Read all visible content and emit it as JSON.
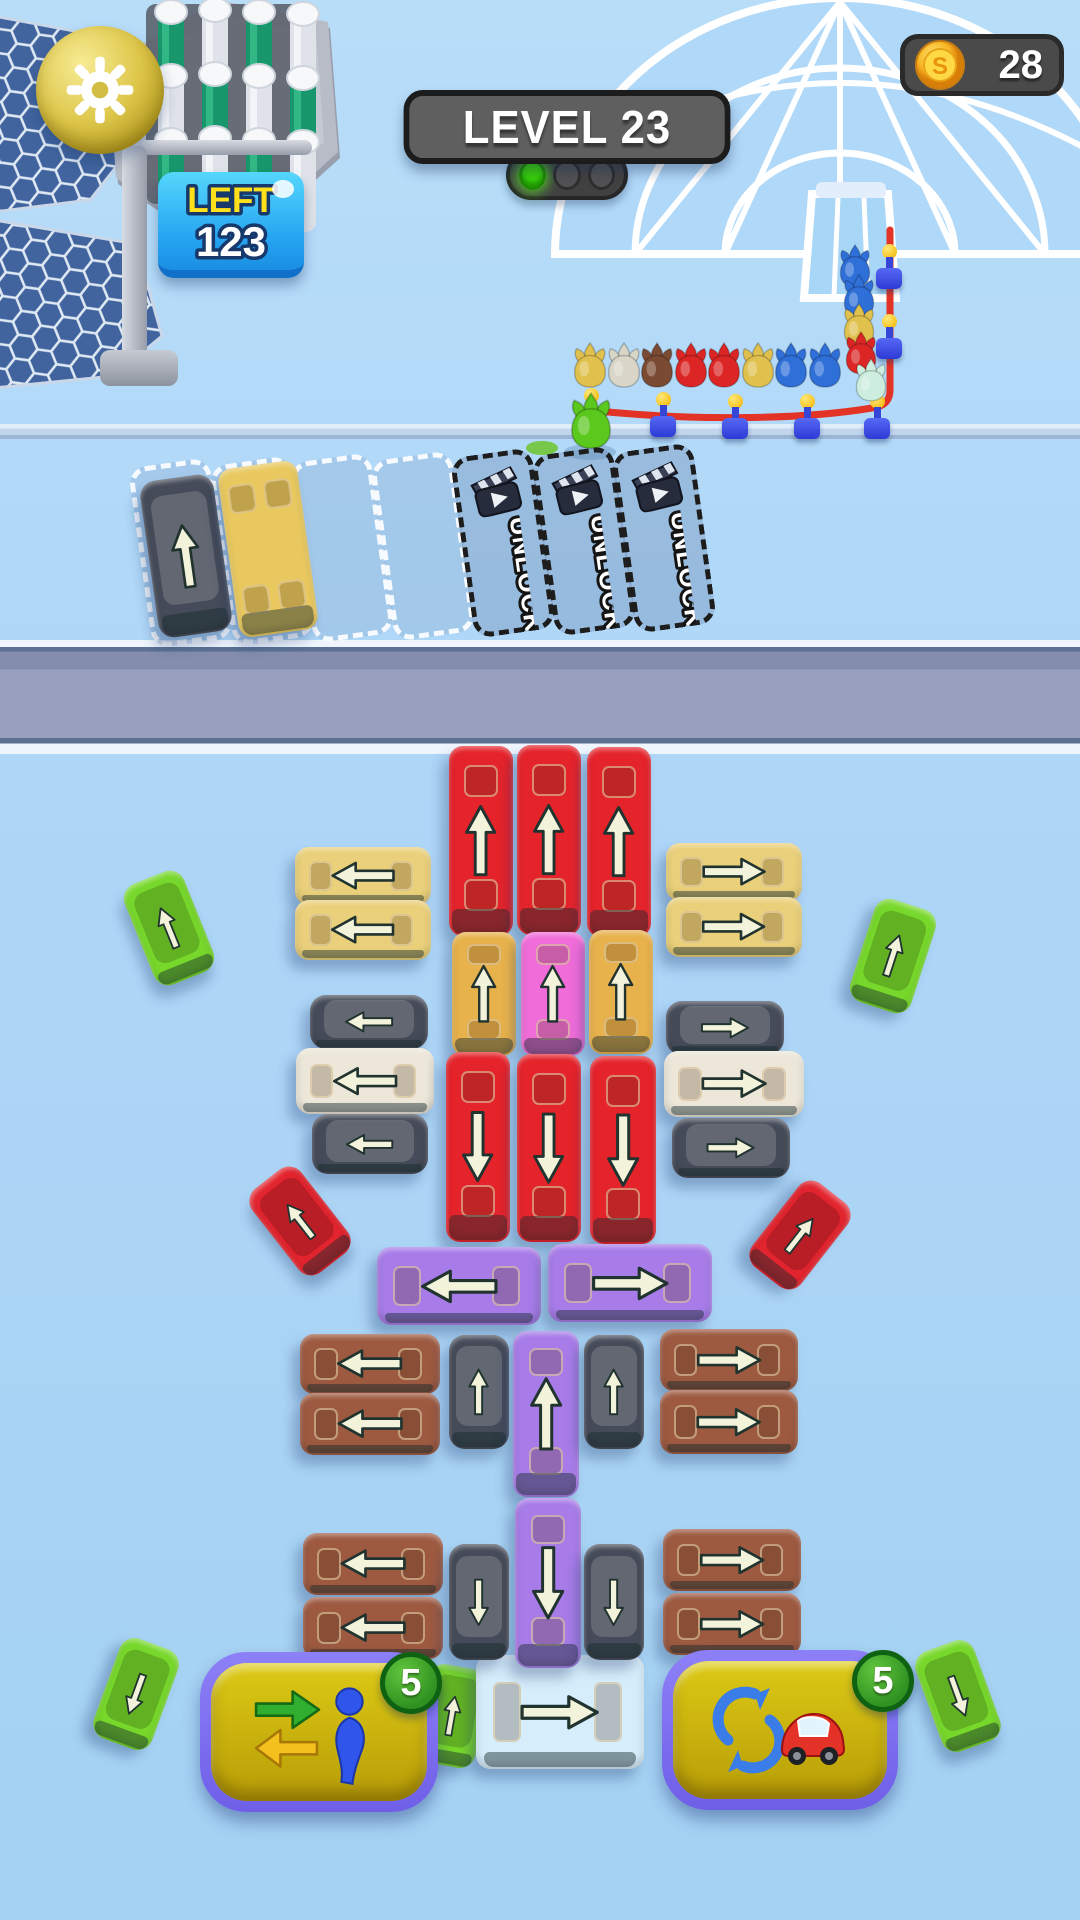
{
  "hud": {
    "level_label": "LEVEL 23",
    "coins": "28",
    "left_label": "LEFT",
    "left_value": "123",
    "unlock_label": "UNLOCK",
    "swap_badge": "5",
    "rotate_badge": "5"
  },
  "icons": {
    "settings": "gear-icon",
    "currency": "coin-icon",
    "locked_slot": "ad-clapper-icon",
    "powerup_left": "swap-passenger-icon",
    "powerup_right": "rotate-car-icon",
    "signal": "traffic-light-icon"
  },
  "colors": {
    "red": "#e5232b",
    "paleYellow": "#ead07a",
    "deepYellow": "#e7b14b",
    "pink": "#ef6cd9",
    "purple": "#a77ce8",
    "brown": "#9d5a41",
    "white": "#ece7d9",
    "black": "#454b58",
    "green": "#77d82b",
    "redCar": "#e2242e",
    "lightBlue": "#d6edfb",
    "slotYellow": "#e9c95f",
    "arrowFill": "#f3f2da",
    "arrowStroke": "#20332f",
    "rope": "#e23326"
  },
  "parking": {
    "slots": [
      {
        "state": "occupied"
      },
      {
        "state": "occupied"
      },
      {
        "state": "empty"
      },
      {
        "state": "empty"
      },
      {
        "state": "locked"
      },
      {
        "state": "locked"
      },
      {
        "state": "locked"
      }
    ]
  },
  "queue": {
    "horizontal": [
      "yellow",
      "white",
      "brown",
      "red",
      "red",
      "yellow",
      "blue",
      "blue"
    ],
    "horizontal_start_x": 570,
    "horizontal_step": 33.5,
    "horizontal_y": 342,
    "vertical": [
      {
        "c": "blue",
        "x": 836,
        "y": 244
      },
      {
        "c": "blue",
        "x": 840,
        "y": 274
      },
      {
        "c": "yellow",
        "x": 840,
        "y": 303
      },
      {
        "c": "red",
        "x": 842,
        "y": 331
      },
      {
        "c": "mint",
        "x": 852,
        "y": 358
      }
    ],
    "loose_green": {
      "x": 566,
      "y": 392
    },
    "char_colors": {
      "yellow": "#e0c14e",
      "white": "#d9d5c7",
      "brown": "#7b4a33",
      "red": "#dc2626",
      "blue": "#2f6fd8",
      "mint": "#cdeede",
      "green": "#5bc81e"
    }
  },
  "rope_posts": [
    {
      "x": 578,
      "y": 388
    },
    {
      "x": 650,
      "y": 392
    },
    {
      "x": 722,
      "y": 394
    },
    {
      "x": 794,
      "y": 394
    },
    {
      "x": 864,
      "y": 394
    },
    {
      "x": 876,
      "y": 314
    },
    {
      "x": 876,
      "y": 244
    }
  ],
  "vehicles": [
    {
      "k": "car",
      "c": "black",
      "x": 186,
      "y": 556,
      "w": 74,
      "h": 158,
      "d": "up",
      "t": -8,
      "z": 6
    },
    {
      "k": "bus",
      "c": "slotYellow",
      "x": 268,
      "y": 549,
      "w": 80,
      "h": 170,
      "d": "up",
      "t": -8,
      "a": 0,
      "win": 4,
      "z": 6
    },
    {
      "k": "bus",
      "c": "red",
      "x": 481,
      "y": 841,
      "w": 64,
      "h": 190,
      "d": "up"
    },
    {
      "k": "bus",
      "c": "red",
      "x": 549,
      "y": 840,
      "w": 64,
      "h": 190,
      "d": "up"
    },
    {
      "k": "bus",
      "c": "red",
      "x": 619,
      "y": 842,
      "w": 64,
      "h": 190,
      "d": "up"
    },
    {
      "k": "bus",
      "c": "paleYellow",
      "x": 363,
      "y": 876,
      "w": 136,
      "h": 58,
      "d": "left"
    },
    {
      "k": "bus",
      "c": "paleYellow",
      "x": 363,
      "y": 930,
      "w": 136,
      "h": 60,
      "d": "left"
    },
    {
      "k": "bus",
      "c": "paleYellow",
      "x": 734,
      "y": 872,
      "w": 136,
      "h": 58,
      "d": "right"
    },
    {
      "k": "bus",
      "c": "paleYellow",
      "x": 734,
      "y": 927,
      "w": 136,
      "h": 60,
      "d": "right"
    },
    {
      "k": "car",
      "c": "green",
      "x": 169,
      "y": 928,
      "w": 64,
      "h": 108,
      "d": "up",
      "t": -22
    },
    {
      "k": "car",
      "c": "green",
      "x": 893,
      "y": 956,
      "w": 64,
      "h": 108,
      "d": "up",
      "t": 18
    },
    {
      "k": "bus",
      "c": "deepYellow",
      "x": 484,
      "y": 994,
      "w": 64,
      "h": 124,
      "d": "up"
    },
    {
      "k": "bus",
      "c": "pink",
      "x": 553,
      "y": 994,
      "w": 64,
      "h": 124,
      "d": "up"
    },
    {
      "k": "bus",
      "c": "deepYellow",
      "x": 621,
      "y": 992,
      "w": 64,
      "h": 124,
      "d": "up"
    },
    {
      "k": "car",
      "c": "black",
      "x": 369,
      "y": 1022,
      "w": 118,
      "h": 54,
      "d": "left"
    },
    {
      "k": "bus",
      "c": "white",
      "x": 365,
      "y": 1081,
      "w": 138,
      "h": 66,
      "d": "left"
    },
    {
      "k": "car",
      "c": "black",
      "x": 370,
      "y": 1144,
      "w": 116,
      "h": 60,
      "d": "left"
    },
    {
      "k": "car",
      "c": "black",
      "x": 725,
      "y": 1028,
      "w": 118,
      "h": 54,
      "d": "right"
    },
    {
      "k": "bus",
      "c": "white",
      "x": 734,
      "y": 1084,
      "w": 140,
      "h": 66,
      "d": "right"
    },
    {
      "k": "car",
      "c": "black",
      "x": 731,
      "y": 1148,
      "w": 118,
      "h": 60,
      "d": "right"
    },
    {
      "k": "bus",
      "c": "red",
      "x": 478,
      "y": 1147,
      "w": 64,
      "h": 190,
      "d": "down"
    },
    {
      "k": "bus",
      "c": "red",
      "x": 549,
      "y": 1148,
      "w": 64,
      "h": 188,
      "d": "down"
    },
    {
      "k": "bus",
      "c": "red",
      "x": 623,
      "y": 1150,
      "w": 66,
      "h": 188,
      "d": "down"
    },
    {
      "k": "car",
      "c": "redCar",
      "x": 300,
      "y": 1221,
      "w": 62,
      "h": 106,
      "d": "up",
      "t": -38
    },
    {
      "k": "car",
      "c": "redCar",
      "x": 800,
      "y": 1235,
      "w": 62,
      "h": 106,
      "d": "up",
      "t": 38
    },
    {
      "k": "bus",
      "c": "purple",
      "x": 459,
      "y": 1286,
      "w": 164,
      "h": 78,
      "d": "left"
    },
    {
      "k": "bus",
      "c": "purple",
      "x": 630,
      "y": 1283,
      "w": 164,
      "h": 78,
      "d": "right"
    },
    {
      "k": "bus",
      "c": "brown",
      "x": 370,
      "y": 1364,
      "w": 140,
      "h": 60,
      "d": "left"
    },
    {
      "k": "bus",
      "c": "brown",
      "x": 370,
      "y": 1424,
      "w": 140,
      "h": 62,
      "d": "left"
    },
    {
      "k": "car",
      "c": "black",
      "x": 479,
      "y": 1392,
      "w": 60,
      "h": 114,
      "d": "up"
    },
    {
      "k": "bus",
      "c": "purple",
      "x": 546,
      "y": 1414,
      "w": 66,
      "h": 166,
      "d": "up"
    },
    {
      "k": "car",
      "c": "black",
      "x": 614,
      "y": 1392,
      "w": 60,
      "h": 114,
      "d": "up"
    },
    {
      "k": "bus",
      "c": "brown",
      "x": 729,
      "y": 1360,
      "w": 138,
      "h": 62,
      "d": "right"
    },
    {
      "k": "bus",
      "c": "brown",
      "x": 729,
      "y": 1422,
      "w": 138,
      "h": 64,
      "d": "right"
    },
    {
      "k": "bus",
      "c": "purple",
      "x": 548,
      "y": 1583,
      "w": 66,
      "h": 170,
      "d": "down"
    },
    {
      "k": "bus",
      "c": "brown",
      "x": 373,
      "y": 1564,
      "w": 140,
      "h": 62,
      "d": "left"
    },
    {
      "k": "bus",
      "c": "brown",
      "x": 373,
      "y": 1628,
      "w": 140,
      "h": 62,
      "d": "left"
    },
    {
      "k": "car",
      "c": "black",
      "x": 479,
      "y": 1602,
      "w": 60,
      "h": 116,
      "d": "down"
    },
    {
      "k": "car",
      "c": "black",
      "x": 614,
      "y": 1602,
      "w": 60,
      "h": 116,
      "d": "down"
    },
    {
      "k": "bus",
      "c": "brown",
      "x": 732,
      "y": 1560,
      "w": 138,
      "h": 62,
      "d": "right"
    },
    {
      "k": "bus",
      "c": "brown",
      "x": 732,
      "y": 1624,
      "w": 138,
      "h": 62,
      "d": "right"
    },
    {
      "k": "car",
      "c": "green",
      "x": 452,
      "y": 1716,
      "w": 60,
      "h": 100,
      "d": "up",
      "t": 10,
      "z": 4
    },
    {
      "k": "bus",
      "c": "lightBlue",
      "x": 560,
      "y": 1712,
      "w": 168,
      "h": 114,
      "d": "right",
      "z": 4
    },
    {
      "k": "car",
      "c": "green",
      "x": 136,
      "y": 1694,
      "w": 62,
      "h": 106,
      "d": "down",
      "t": 20
    },
    {
      "k": "car",
      "c": "green",
      "x": 958,
      "y": 1696,
      "w": 62,
      "h": 106,
      "d": "down",
      "t": -20
    }
  ]
}
